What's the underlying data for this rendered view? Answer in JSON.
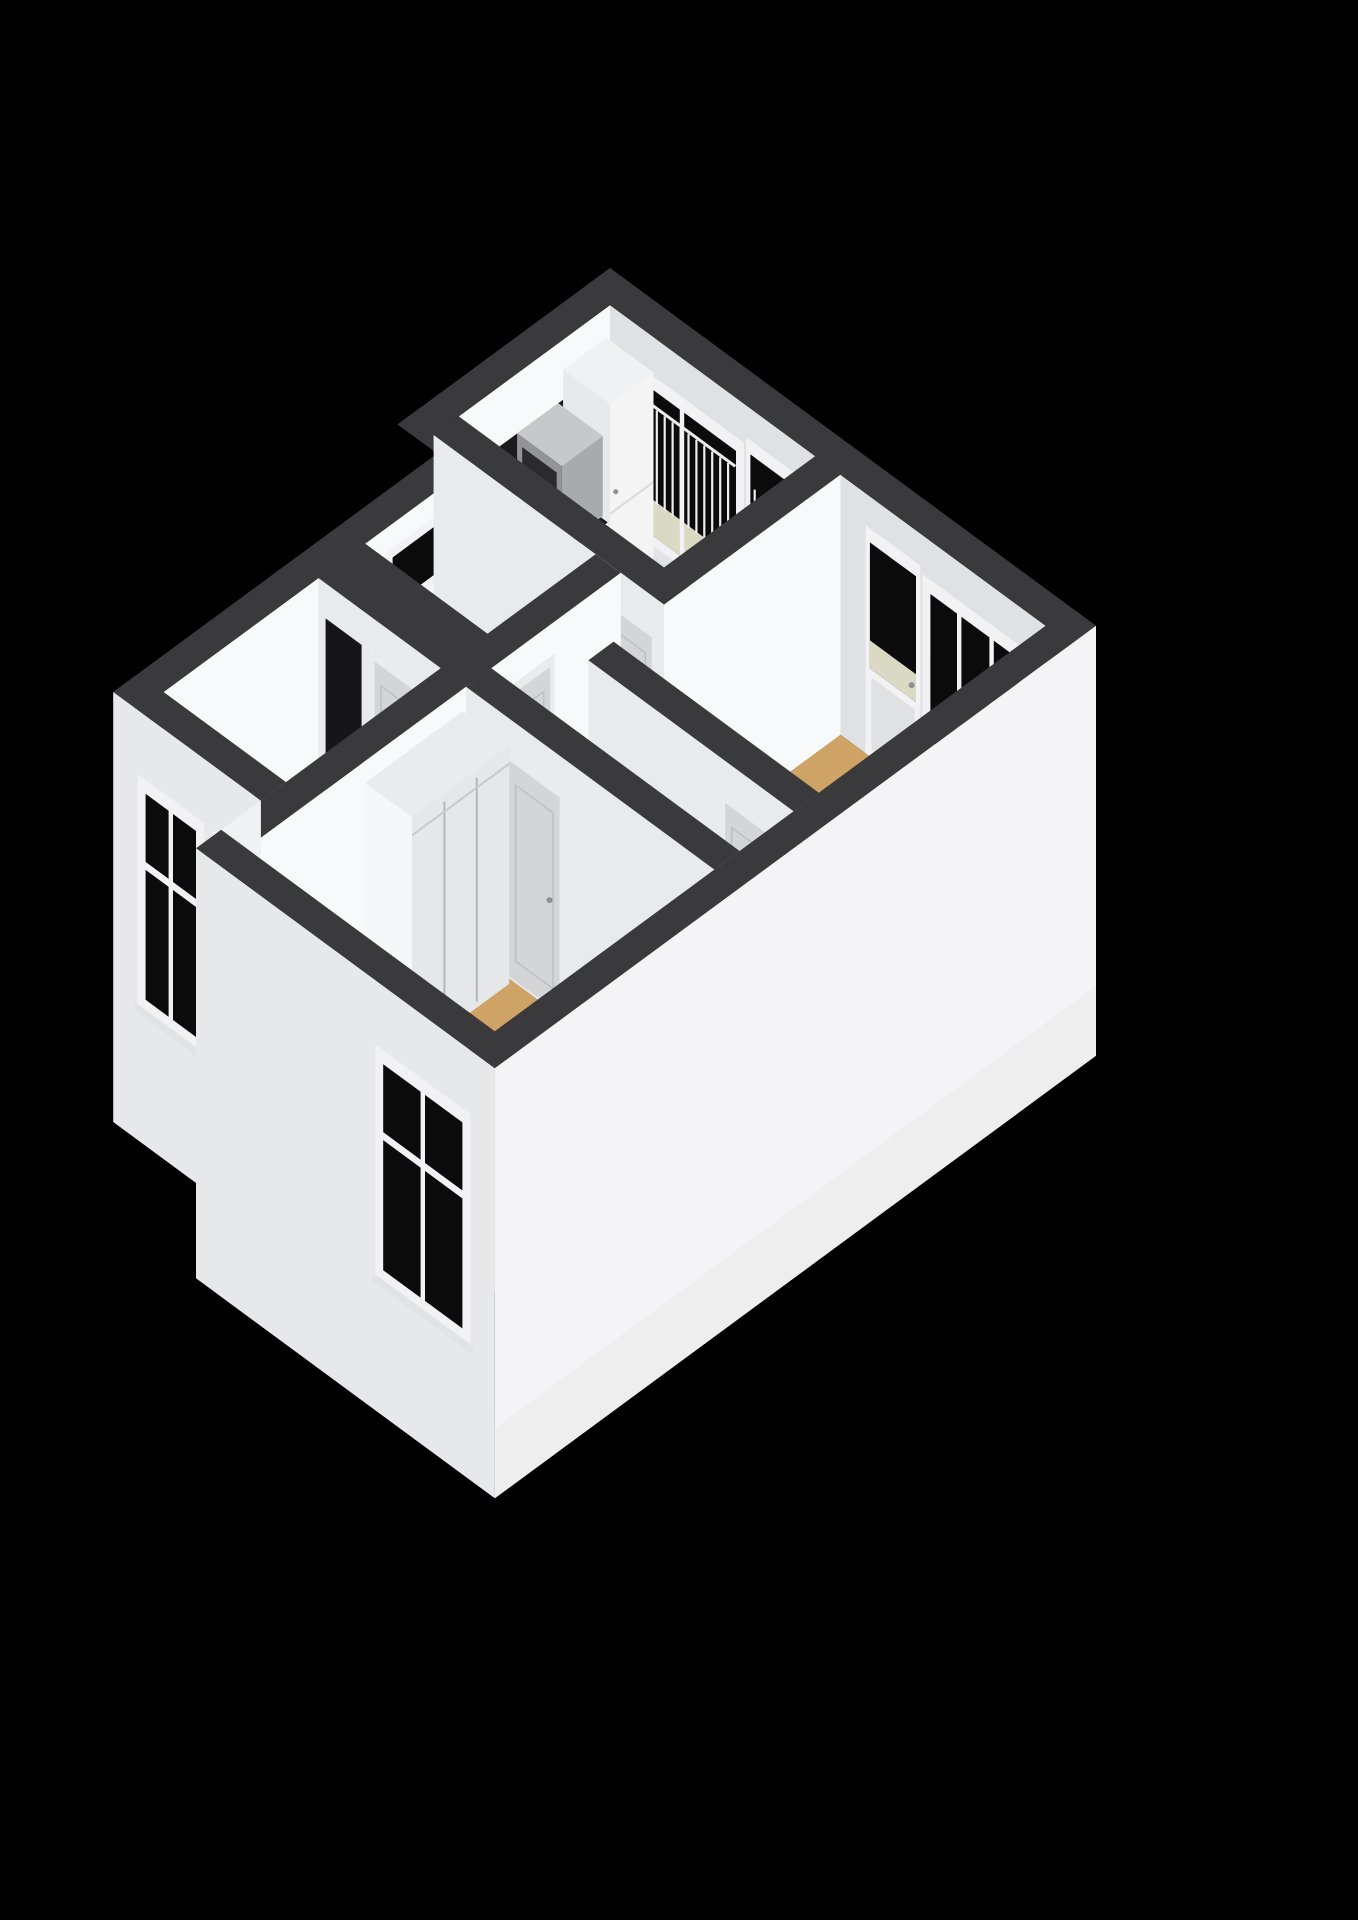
{
  "view": {
    "title": "3D isometric floor plan of an apartment",
    "background": "#000000"
  },
  "palette": {
    "background": "#000000",
    "wall_top": "#3a3a3c",
    "wall_face_bright": "#f8f9fa",
    "wall_face_light": "#e9eaec",
    "wall_face_ne": "#dfe1e4",
    "skirt_sw": "#e7e8ea",
    "skirt_se": "#f4f4f6",
    "step_face": "#f0f1f3",
    "floor_tan": "#cfa365",
    "floor_tan_light": "#d7ad72",
    "floor_kitchen": "#b8c3d2",
    "floor_bath": "#edeff1",
    "floor_balcony": "#d9d9c4",
    "glass_dark": "#0b0b0c",
    "frame_white": "#f2f2f4",
    "door_panel": "#d4d5d7",
    "door_frame": "#eaebed",
    "door_inset": "#bfc0c2",
    "handle": "#8f9092",
    "counter_top": "#1d1d1f",
    "backsplash": "#1b1b1d",
    "cabinet_front": "#f4f4f5",
    "cabinet_side": "#e8e9eb",
    "cabinet_top": "#f0f1f2",
    "seam": "#d8d9db",
    "hob": "#151517",
    "burner": "#85868a",
    "microwave_body": "#c7c8ca",
    "microwave_face": "#939496",
    "microwave_side": "#a9aaac",
    "microwave_glass": "#2b2b2d",
    "railing": "#ededee",
    "fixture_white": "#f6f7f8",
    "fixture_edge": "#c7c8ca",
    "closet_face": "#e6e7e9",
    "closet_top": "#eaebed",
    "meter_dark": "#161618",
    "sill": "#e2e3e5"
  },
  "rooms": [
    {
      "id": "kitchen",
      "label": "kitchen",
      "floor": "floor_kitchen",
      "fixtures": [
        "kitchen-window",
        "balcony-door",
        "tall-cabinet",
        "kitchen-counter",
        "gas-hob",
        "microwave",
        "backsplash"
      ]
    },
    {
      "id": "balcony",
      "label": "balcony",
      "floor": "floor_balcony",
      "fixtures": [
        "balcony-railing"
      ]
    },
    {
      "id": "bathroom",
      "label": "bathroom",
      "floor": "floor_bath",
      "fixtures": [
        "slit-window",
        "wash-basin",
        "shower-screen",
        "shower-tray",
        "bathroom-door"
      ]
    },
    {
      "id": "hallway",
      "label": "hallway",
      "floor": "floor_tan_light",
      "fixtures": [
        "kitchen-door",
        "bathroom-door",
        "bedroom-door",
        "living-room-door"
      ]
    },
    {
      "id": "bedroom-right",
      "label": "bedroom",
      "floor": "floor_tan",
      "fixtures": [
        "balcony-door",
        "bedroom-window",
        "hall-door"
      ]
    },
    {
      "id": "living-room",
      "label": "living room",
      "floor": "floor_tan",
      "fixtures": [
        "window-left",
        "window-right",
        "meter-cupboard",
        "hall-door"
      ]
    },
    {
      "id": "bedroom-bottom",
      "label": "bedroom",
      "floor": "floor_tan",
      "fixtures": [
        "built-in-closet",
        "bedroom-window",
        "hall-door"
      ]
    }
  ]
}
